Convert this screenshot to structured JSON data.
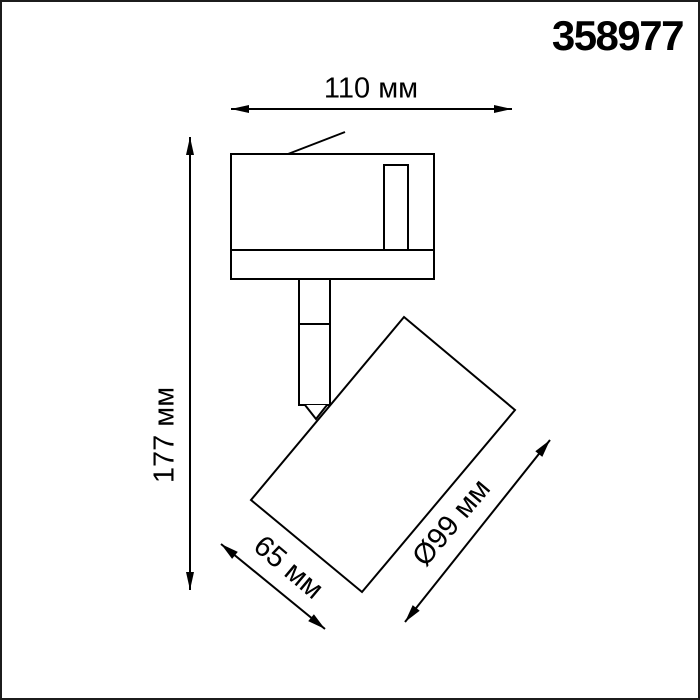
{
  "page": {
    "background_color": "#ffffff",
    "frame_color": "#1c1c1c"
  },
  "product": {
    "article": "358977"
  },
  "drawing": {
    "type": "technical-dimension-drawing",
    "subject": "track-mounted swivel spot light, side view",
    "line_color": "#000000",
    "dimensions": {
      "width": "110 мм",
      "height": "177 мм",
      "depth": "65 мм",
      "diameter": "Ø99 мм"
    }
  }
}
